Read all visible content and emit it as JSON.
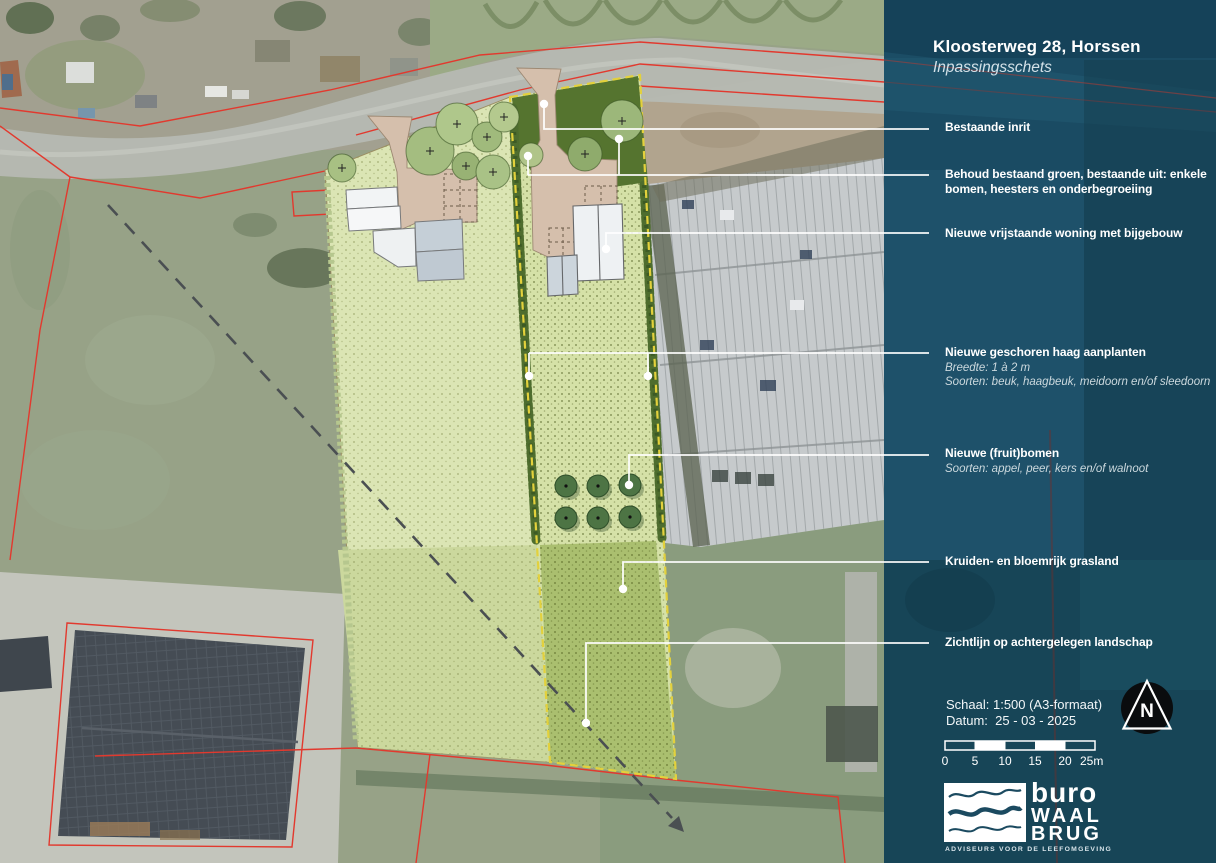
{
  "document": {
    "title": "Kloosterweg 28, Horssen",
    "subtitle": "Inpassingsschets"
  },
  "annotations": [
    {
      "title": "Bestaande inrit"
    },
    {
      "title": "Behoud bestaand groen, bestaande uit: enkele bomen, heesters en onderbegroeiing"
    },
    {
      "title": "Nieuwe vrijstaande woning met bijgebouw"
    },
    {
      "title": "Nieuwe geschoren haag aanplanten",
      "sub1": "Breedte: 1 à 2 m",
      "sub2": "Soorten: beuk, haagbeuk, meidoorn en/of sleedoorn"
    },
    {
      "title": "Nieuwe (fruit)bomen",
      "sub1": "Soorten: appel, peer, kers en/of walnoot"
    },
    {
      "title": "Kruiden- en bloemrijk grasland"
    },
    {
      "title": "Zichtlijn op achtergelegen landschap"
    }
  ],
  "meta": {
    "scale": "Schaal: 1:500 (A3-formaat)",
    "date": "Datum:  25 - 03 - 2025"
  },
  "scale_bar": {
    "ticks": [
      "0",
      "5",
      "10",
      "15",
      "20",
      "25m"
    ]
  },
  "north_arrow": {
    "letter": "N"
  },
  "logo": {
    "word1": "buro",
    "word2": "WAAL",
    "word3": "BRUG",
    "tagline": "ADVISEURS VOOR DE LEEFOMGEVING"
  },
  "colors": {
    "panel": "#1a4b63",
    "parcel_light": "#dbe5b4",
    "parcel_mid": "#d5e1a7",
    "grass_rich": "#aabf6f",
    "hedge_dark": "#4e6d2e",
    "boundary_dash": "#e3d13c",
    "cadastral_red": "#e2392e",
    "driveway": "#d5bfac"
  }
}
